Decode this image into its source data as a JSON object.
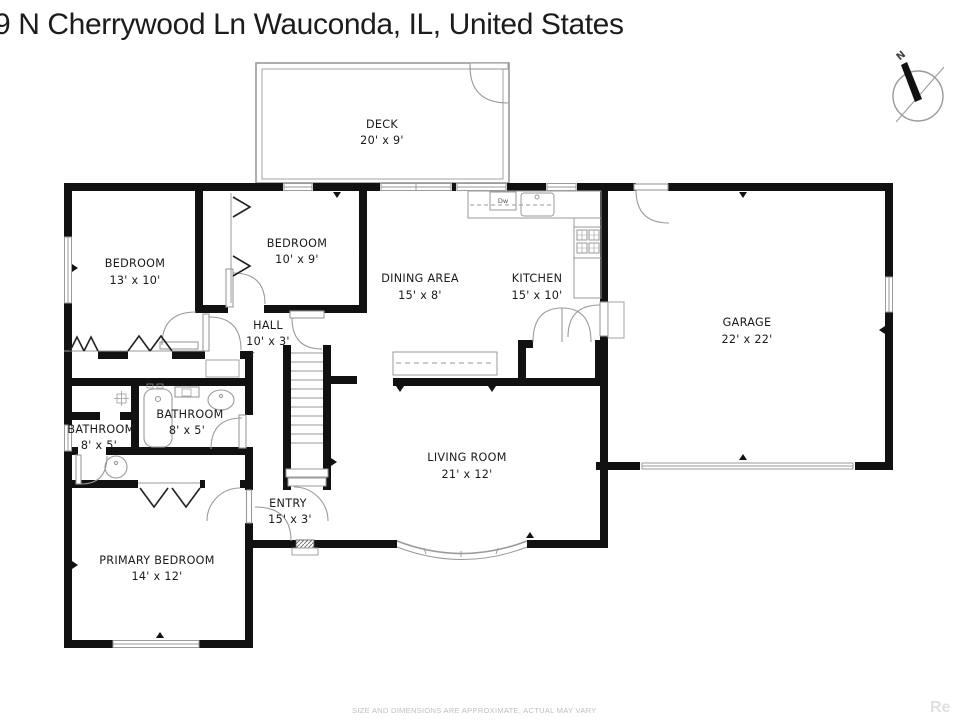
{
  "title": "9 N Cherrywood Ln Wauconda, IL, United States",
  "rooms": {
    "deck": {
      "name": "DECK",
      "dims": "20' x 9'"
    },
    "bedroom_left": {
      "name": "BEDROOM",
      "dims": "13' x 10'"
    },
    "bedroom_top": {
      "name": "BEDROOM",
      "dims": "10' x 9'"
    },
    "dining": {
      "name": "DINING AREA",
      "dims": "15' x 8'"
    },
    "kitchen": {
      "name": "KITCHEN",
      "dims": "15' x 10'"
    },
    "garage": {
      "name": "GARAGE",
      "dims": "22' x 22'"
    },
    "hall": {
      "name": "HALL",
      "dims": "10' x 3'"
    },
    "bathroom_hall": {
      "name": "BATHROOM",
      "dims": "8' x 5'"
    },
    "bathroom_left": {
      "name": "BATHROOM",
      "dims": "8' x 5'"
    },
    "living": {
      "name": "LIVING ROOM",
      "dims": "21' x 12'"
    },
    "entry": {
      "name": "ENTRY",
      "dims": "15' x 3'"
    },
    "primary": {
      "name": "PRIMARY BEDROOM",
      "dims": "14' x 12'"
    }
  },
  "annotations": {
    "dishwasher": "Dw",
    "hall_marker": "z"
  },
  "compass": {
    "north": "N"
  },
  "footer": {
    "disclaimer": "SIZE AND DIMENSIONS ARE APPROXIMATE, ACTUAL MAY VARY",
    "watermark": "Re"
  },
  "colors": {
    "wall": "#111111",
    "thin_line": "#9a9a9a",
    "label": "#1a1a1a",
    "muted": "#bfbfbf"
  }
}
